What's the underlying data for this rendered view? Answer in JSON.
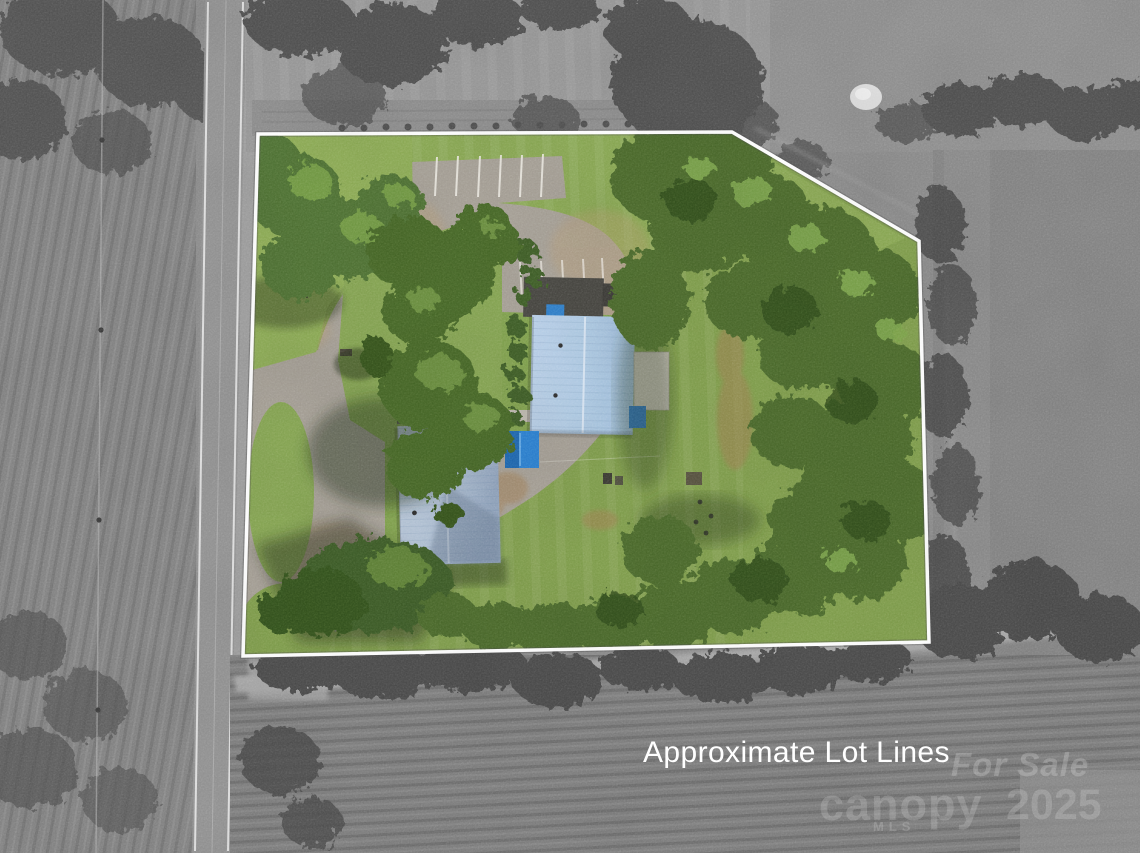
{
  "overlay": {
    "caption": "Approximate Lot Lines",
    "watermark": {
      "line1": "For Sale",
      "brand": "canopy",
      "brand_sub": "MLS",
      "year": "2025"
    }
  },
  "lot": {
    "outline_points": "258,134 732,132 919,241 929,642 243,656",
    "outline_color": "#ffffff"
  },
  "palette": {
    "lot_grass": "#7e9c4a",
    "front_lawn": "#8cab54",
    "forest_green": "#48682c",
    "roof_blue": "#aec9e2",
    "roof_blue_2": "#b0c0d4",
    "tarp_blue": "#2b80d2",
    "asphalt": "#a49e94",
    "concrete": "#c6c1b7",
    "road_gray": "#909090",
    "mono_field": "#858585",
    "dirt_tan": "#b89a6e",
    "caption_text": "#ffffff"
  }
}
